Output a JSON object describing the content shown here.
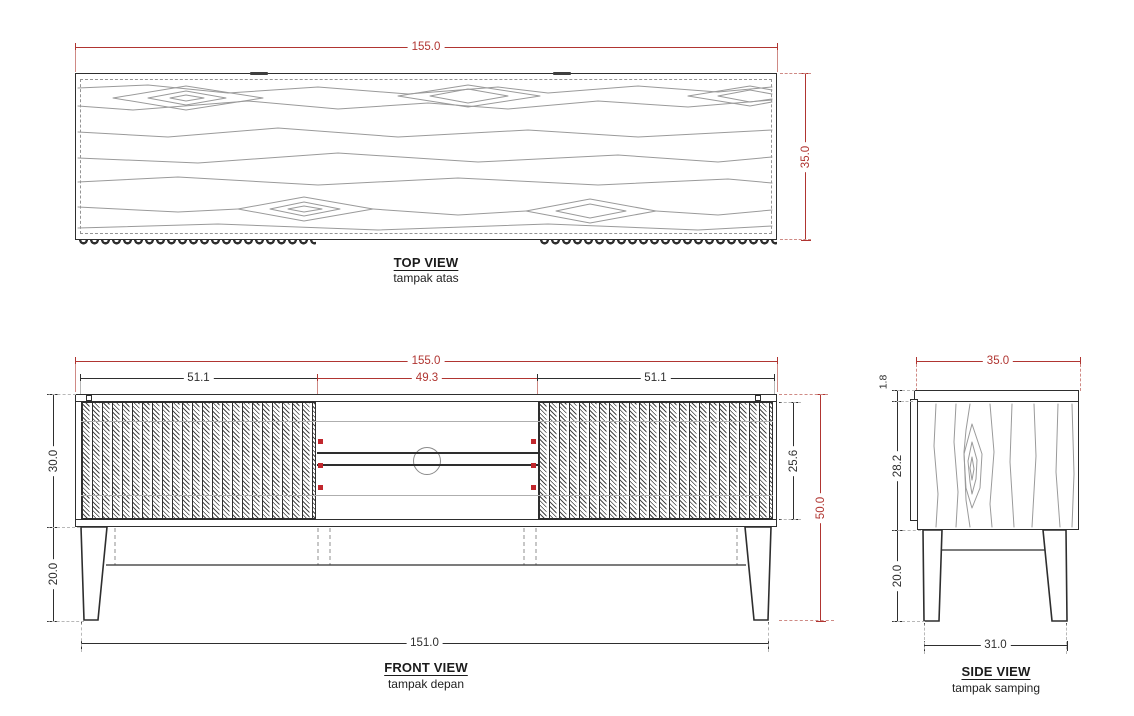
{
  "colors": {
    "dimension_red": "#b03531",
    "line_dark": "#2e2e2e",
    "grain_gray": "#9a9a9a",
    "pin_red": "#c1272d"
  },
  "views": {
    "top": {
      "title": "TOP VIEW",
      "subtitle": "tampak atas"
    },
    "front": {
      "title": "FRONT VIEW",
      "subtitle": "tampak depan"
    },
    "side": {
      "title": "SIDE VIEW",
      "subtitle": "tampak samping"
    }
  },
  "dims": {
    "top_width": "155.0",
    "top_depth": "35.0",
    "front_width": "155.0",
    "front_left_door": "51.1",
    "front_middle": "49.3",
    "front_right_door": "51.1",
    "front_body_height": "30.0",
    "front_leg_height": "20.0",
    "front_door_height": "25.6",
    "front_total_height": "50.0",
    "front_leg_span": "151.0",
    "side_depth": "35.0",
    "side_top_thickness": "1.8",
    "side_body_height": "28.2",
    "side_leg_height": "20.0",
    "side_leg_span": "31.0"
  }
}
